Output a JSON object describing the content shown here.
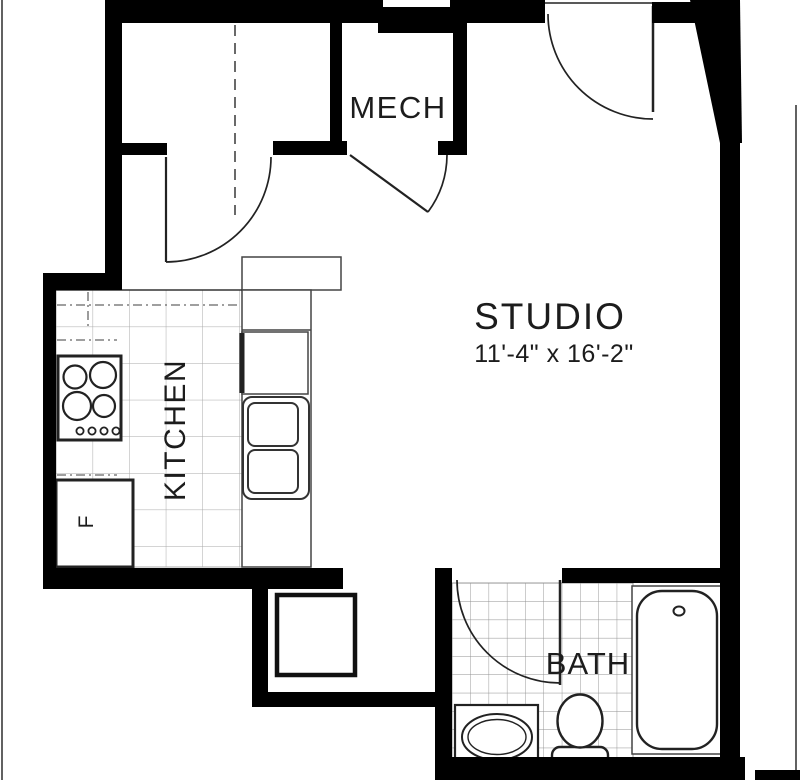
{
  "plan": {
    "type": "apartment-floor-plan",
    "rooms": {
      "mech": {
        "label": "MECH"
      },
      "studio": {
        "label": "STUDIO",
        "dimensions": "11'-4\" x 16'-2\""
      },
      "kitchen": {
        "label": "KITCHEN"
      },
      "bath": {
        "label": "BATH"
      },
      "refrigerator": {
        "label": "F"
      }
    },
    "colors": {
      "wall": "#000000",
      "background": "#ffffff",
      "fixture_outline": "#2a2a2a",
      "kitchen_tile_grid": "#a8a8a8",
      "bath_tile_grid": "#8f8f8f",
      "thin_line": "#3a3a3a"
    }
  }
}
